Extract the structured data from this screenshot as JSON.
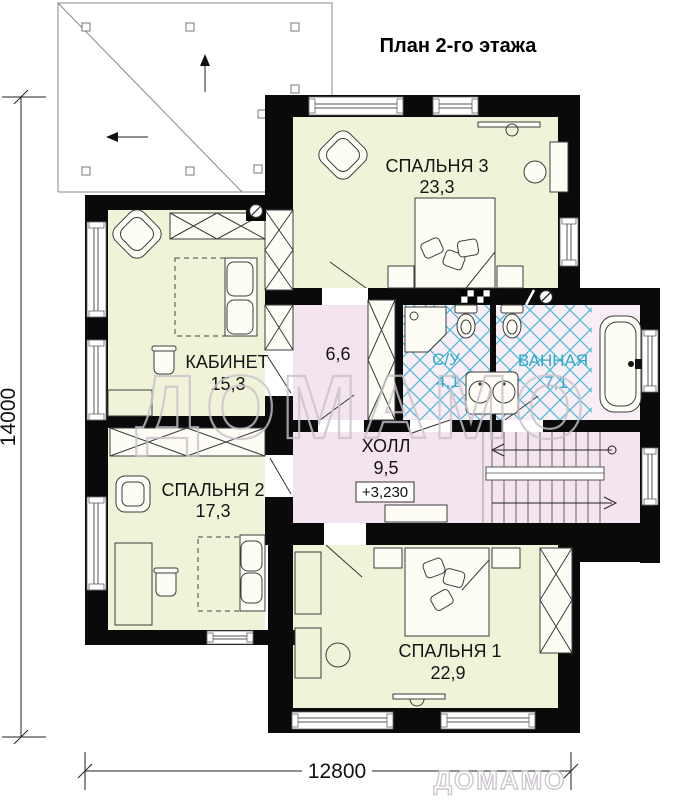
{
  "title": "План 2-го этажа",
  "rooms": [
    {
      "id": "bedroom3",
      "name": "СПАЛЬНЯ 3",
      "area": "23,3"
    },
    {
      "id": "office",
      "name": "КАБИНЕТ",
      "area": "15,3"
    },
    {
      "id": "wardrobe",
      "name": "",
      "area": "6,6"
    },
    {
      "id": "wc",
      "name": "С/У",
      "area": "4,1"
    },
    {
      "id": "bathroom",
      "name": "ВАННАЯ",
      "area": "7,1"
    },
    {
      "id": "bedroom2",
      "name": "СПАЛЬНЯ 2",
      "area": "17,3"
    },
    {
      "id": "hall",
      "name": "ХОЛЛ",
      "area": "9,5",
      "elevation": "+3,230"
    },
    {
      "id": "bedroom1",
      "name": "СПАЛЬНЯ 1",
      "area": "22,9"
    }
  ],
  "dimensions": {
    "height_label": "14000",
    "width_label": "12800"
  },
  "watermark": {
    "large": "ДОМАМО",
    "small": "ДОМАМО"
  },
  "colors": {
    "wall": "#0a0a0a",
    "room_cream": "#f1f3d9",
    "room_pink": "#f3e4ef",
    "bath_bg": "#f8eef5",
    "tile_line": "#4ab7d7",
    "bath_text": "#2ba9ce"
  }
}
